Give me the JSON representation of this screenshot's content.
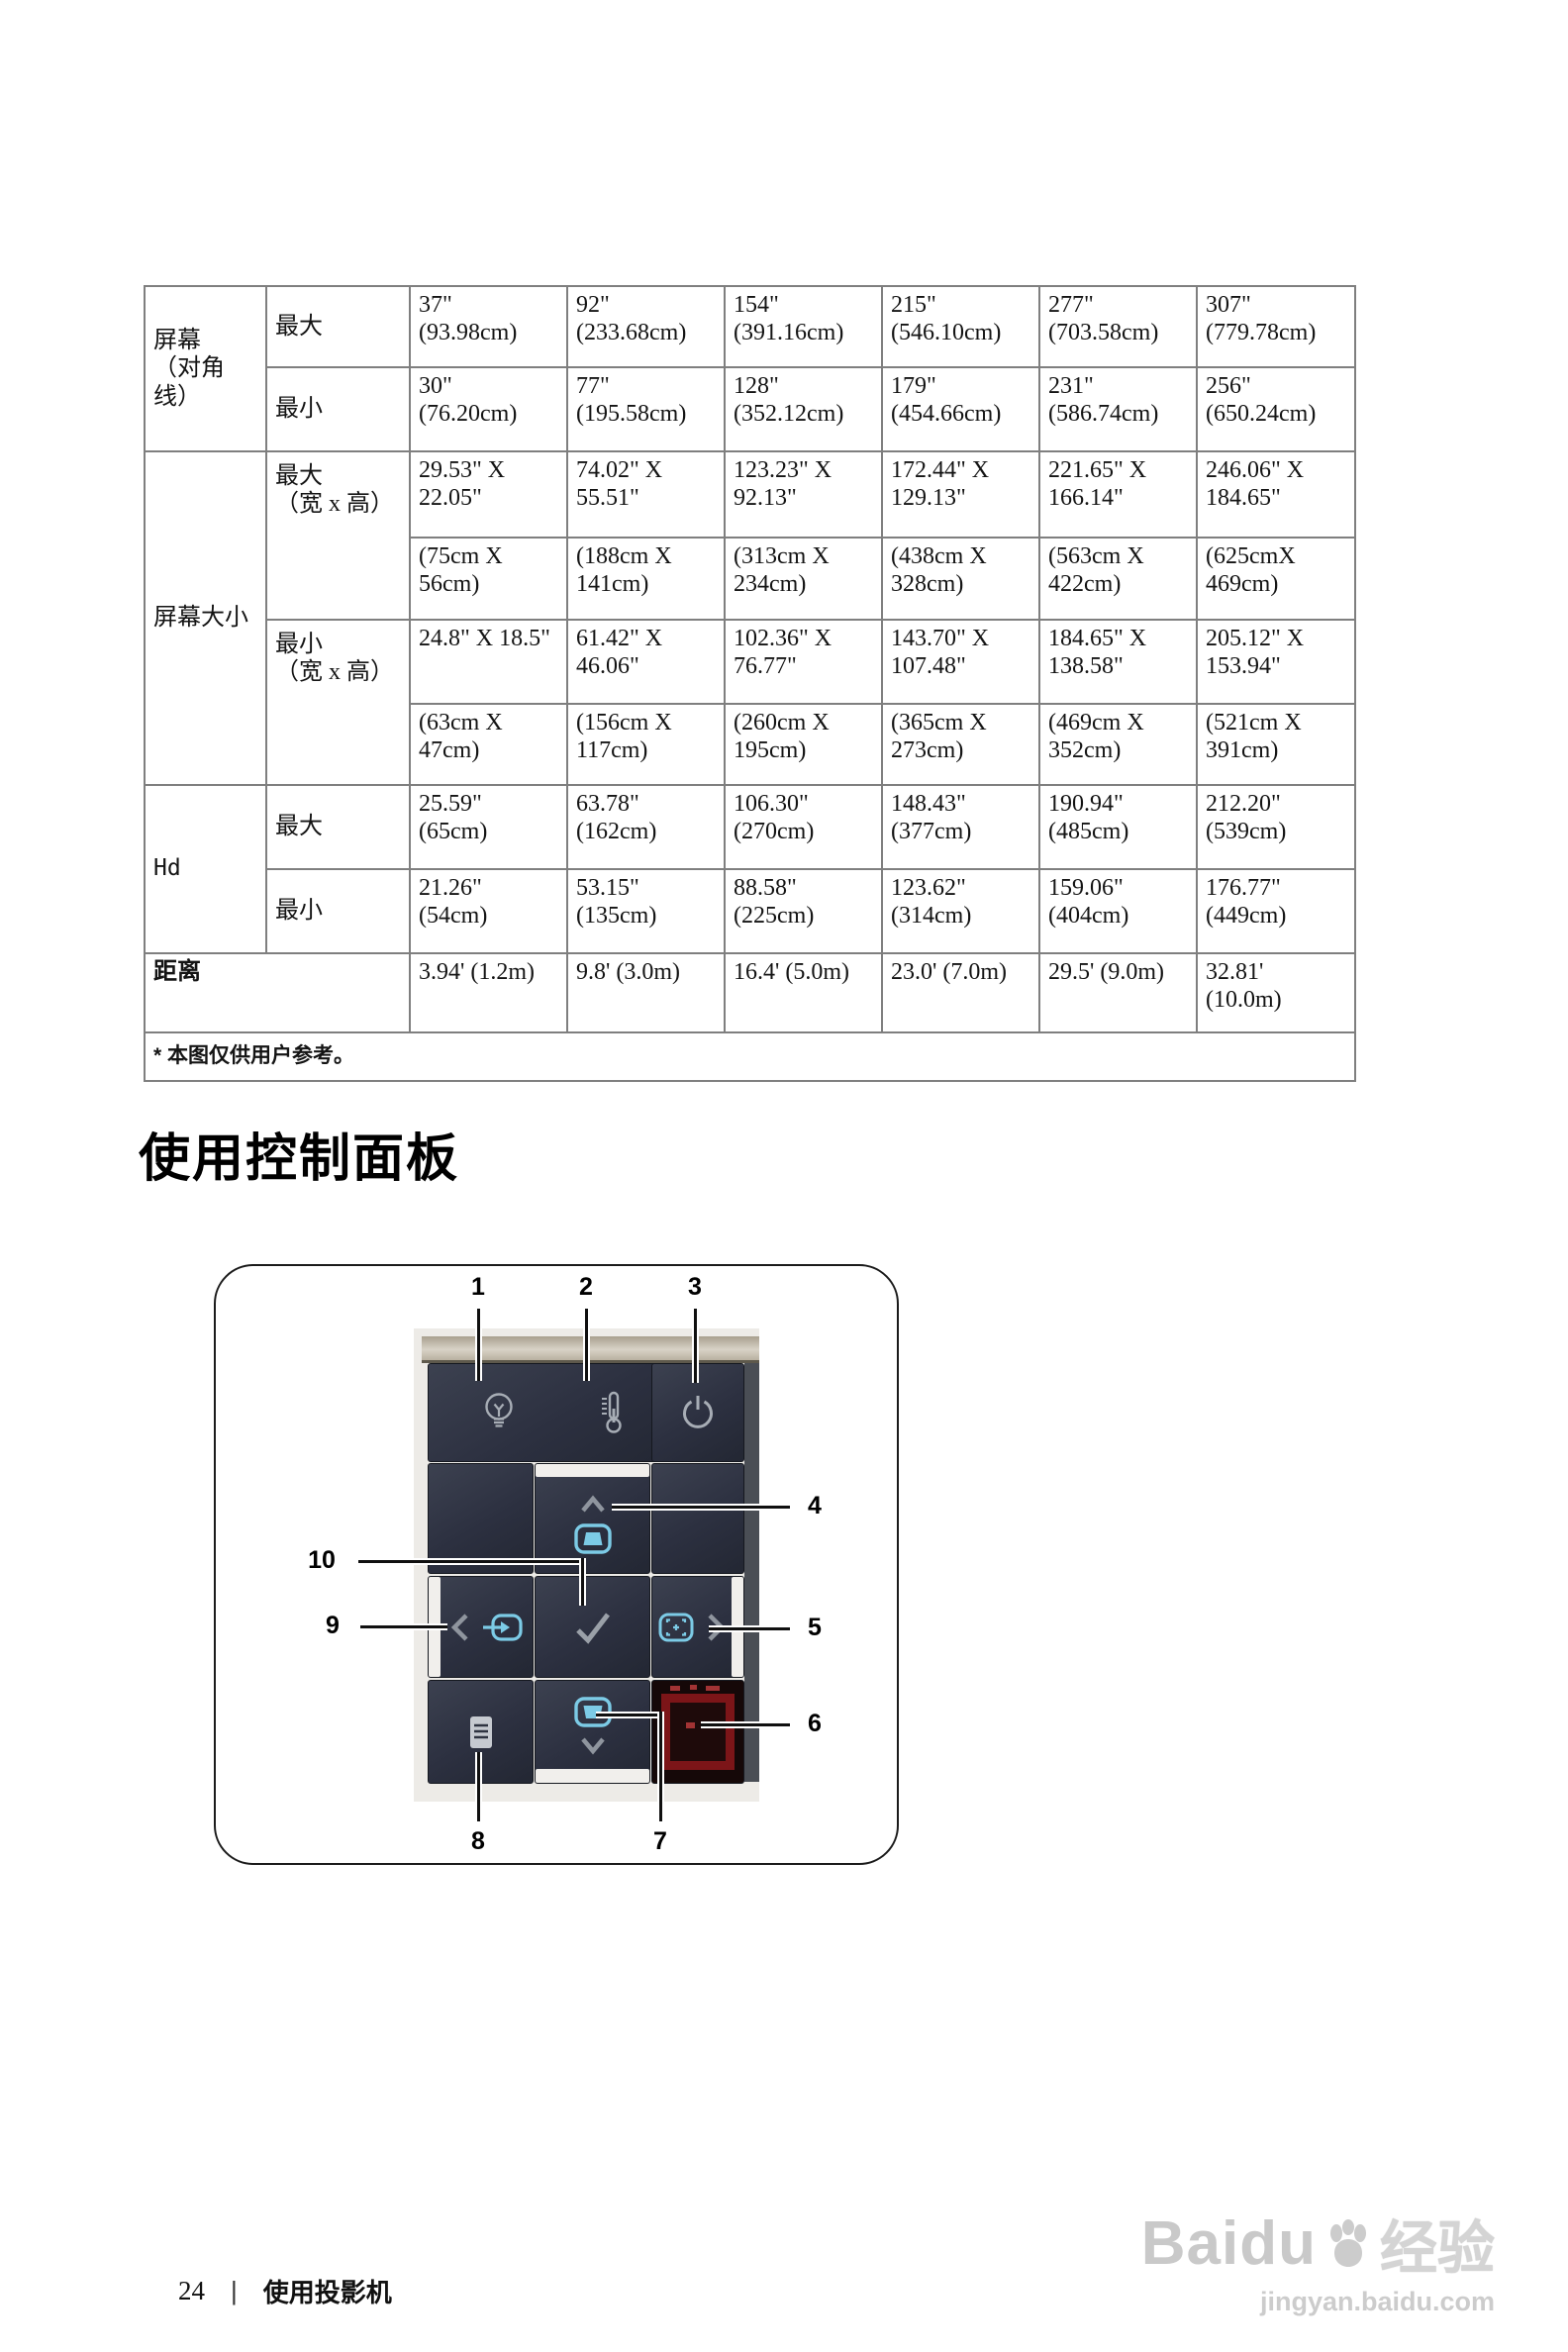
{
  "table": {
    "groups": [
      {
        "label": "屏幕\n（对角线）",
        "rows": [
          {
            "sub": "最大",
            "cells": [
              "37\"\n(93.98cm)",
              "92\"\n(233.68cm)",
              "154\"\n(391.16cm)",
              "215\"\n(546.10cm)",
              "277\"\n(703.58cm)",
              "307\"\n(779.78cm)"
            ]
          },
          {
            "sub": "最小",
            "cells": [
              "30\"\n(76.20cm)",
              "77\"\n(195.58cm)",
              "128\"\n(352.12cm)",
              "179\"\n(454.66cm)",
              "231\"\n(586.74cm)",
              "256\"\n(650.24cm)"
            ]
          }
        ]
      },
      {
        "label": "屏幕大小",
        "rows": [
          {
            "sub": "最大\n（宽 x 高）",
            "cells": [
              "29.53\" X\n22.05\"",
              "74.02\" X\n55.51\"",
              "123.23\" X\n92.13\"",
              "172.44\" X\n129.13\"",
              "221.65\" X\n166.14\"",
              "246.06\" X\n184.65\""
            ]
          },
          {
            "sub": "",
            "cells": [
              "(75cm X\n56cm)",
              "(188cm X\n141cm)",
              "(313cm X\n234cm)",
              "(438cm X\n328cm)",
              "(563cm X\n422cm)",
              "(625cmX\n469cm)"
            ]
          },
          {
            "sub": "最小\n（宽 x 高）",
            "cells": [
              "24.8\" X 18.5\"",
              "61.42\" X\n46.06\"",
              "102.36\" X\n76.77\"",
              "143.70\" X\n107.48\"",
              "184.65\" X\n138.58\"",
              "205.12\" X\n153.94\""
            ]
          },
          {
            "sub": "",
            "cells": [
              "(63cm X\n47cm)",
              "(156cm X\n117cm)",
              "(260cm X\n195cm)",
              "(365cm X\n273cm)",
              "(469cm X\n352cm)",
              "(521cm X\n391cm)"
            ]
          }
        ]
      },
      {
        "label": "Hd",
        "rows": [
          {
            "sub": "最大",
            "cells": [
              "25.59\"\n(65cm)",
              "63.78\"\n(162cm)",
              "106.30\"\n(270cm)",
              "148.43\"\n(377cm)",
              "190.94\"\n(485cm)",
              "212.20\"\n(539cm)"
            ]
          },
          {
            "sub": "最小",
            "cells": [
              "21.26\"\n(54cm)",
              "53.15\"\n(135cm)",
              "88.58\"\n(225cm)",
              "123.62\"\n(314cm)",
              "159.06\"\n(404cm)",
              "176.77\"\n(449cm)"
            ]
          }
        ]
      },
      {
        "label": "距离",
        "cells": [
          "3.94' (1.2m)",
          "9.8' (3.0m)",
          "16.4' (5.0m)",
          "23.0' (7.0m)",
          "29.5' (9.0m)",
          "32.81'\n(10.0m)"
        ]
      }
    ],
    "footnote": "* 本图仅供用户参考。"
  },
  "section": {
    "heading": "使用控制面板"
  },
  "panel": {
    "callouts": {
      "c1": "1",
      "c2": "2",
      "c3": "3",
      "c4": "4",
      "c5": "5",
      "c6": "6",
      "c7": "7",
      "c8": "8",
      "c9": "9",
      "c10": "10"
    },
    "icons": [
      "lamp-icon",
      "thermometer-icon",
      "power-icon",
      "chevron-up-icon",
      "keystone-icon",
      "chevron-left-icon",
      "source-icon",
      "checkmark-icon",
      "auto-adjust-icon",
      "chevron-right-icon",
      "menu-icon",
      "keystone-icon",
      "chevron-down-icon",
      "ir-receiver-window"
    ]
  },
  "footer": {
    "page_number": "24",
    "separator": "|",
    "title": "使用投影机"
  },
  "watermark": {
    "brand": "Baidu",
    "suffix": "经验",
    "url": "jingyan.baidu.com"
  }
}
